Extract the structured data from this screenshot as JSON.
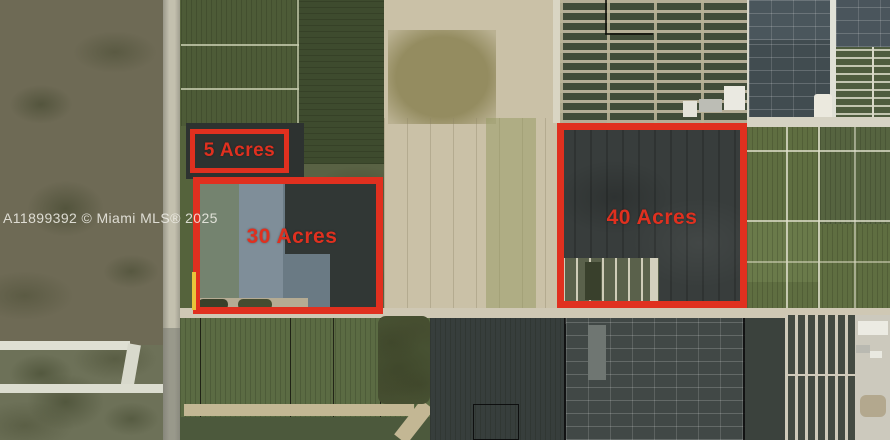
{
  "photo": {
    "description": "Aerial satellite view of agricultural land and nursery parcels with red acreage outlines",
    "watermark": "A11899392 © Miami MLS® 2025"
  },
  "parcels": [
    {
      "label": "5 Acres"
    },
    {
      "label": "30 Acres"
    },
    {
      "label": "40 Acres"
    }
  ],
  "colors": {
    "annotation_red": "#e0301f",
    "highlight_yellow": "#e8c63a",
    "watermark_text": "#f2f1ea"
  }
}
